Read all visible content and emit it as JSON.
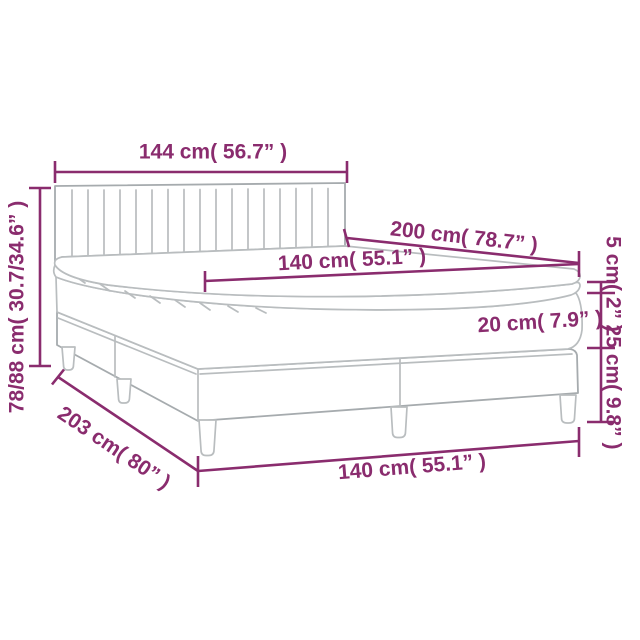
{
  "diagram": {
    "type": "product-dimension-diagram",
    "subject": "box spring bed with channel-tufted headboard, mattress and topper",
    "accent_color": "#8a2c6e",
    "line_color": "#b9bdbf",
    "background_color": "#ffffff",
    "measurements": {
      "headboard_width": "144 cm( 56.7” )",
      "height_range": "78/88 cm( 30.7/34.6” )",
      "bed_length": "200 cm( 78.7” )",
      "mattress_width": "140 cm( 55.1” )",
      "topper_thickness": "5 cm( 2” )",
      "mattress_thickness": "20 cm( 7.9” )",
      "base_height": "25 cm( 9.8” )",
      "base_length": "203 cm( 80” )",
      "base_width": "140 cm( 55.1” )"
    }
  }
}
